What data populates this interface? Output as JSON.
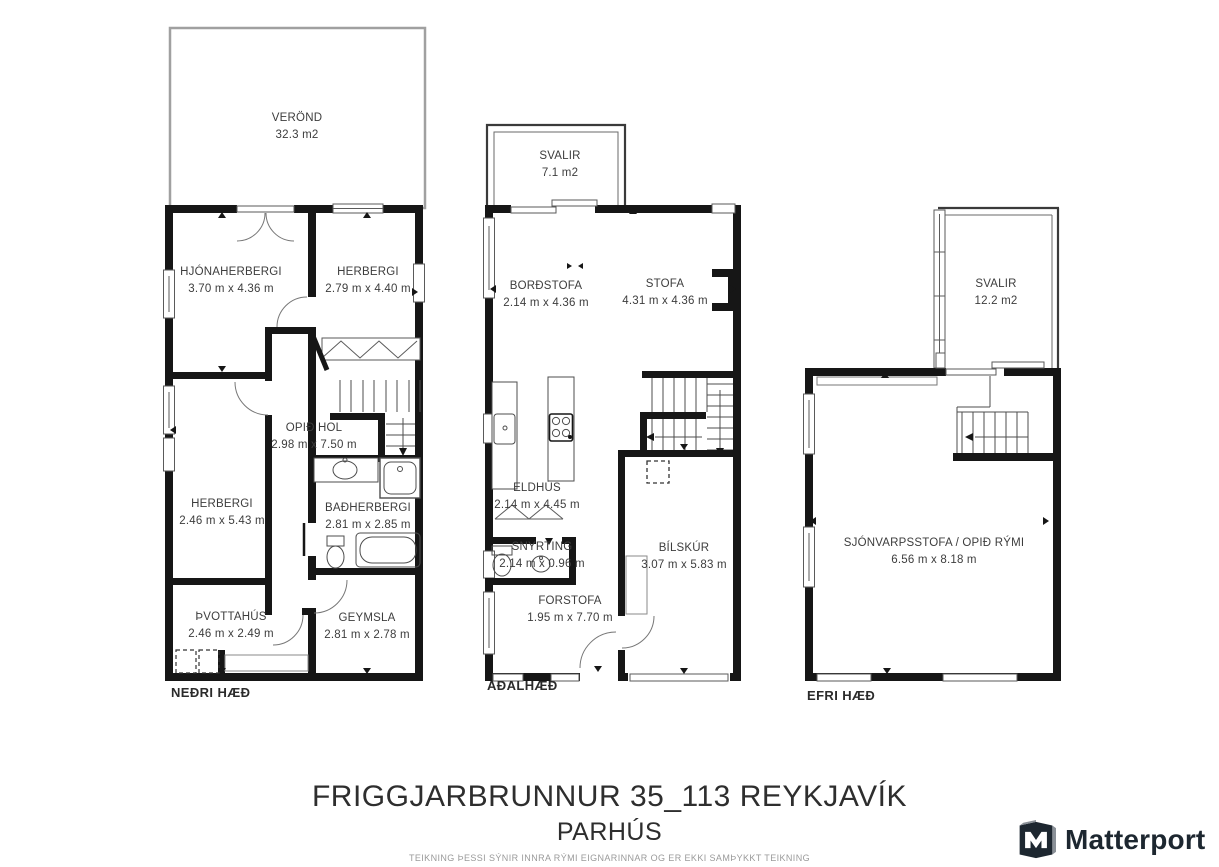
{
  "floors": [
    {
      "label": "NEÐRI HÆÐ",
      "rooms": [
        {
          "name": "VERÖND",
          "dims": "32.3 m2"
        },
        {
          "name": "HJÓNAHERBERGI",
          "dims": "3.70 m x 4.36 m"
        },
        {
          "name": "HERBERGI",
          "dims": "2.79 m x 4.40 m"
        },
        {
          "name": "OPIÐ HOL",
          "dims": "2.98 m x 7.50 m"
        },
        {
          "name": "HERBERGI",
          "dims": "2.46 m x 5.43 m"
        },
        {
          "name": "BAÐHERBERGI",
          "dims": "2.81 m x 2.85 m"
        },
        {
          "name": "ÞVOTTAHÚS",
          "dims": "2.46 m x 2.49 m"
        },
        {
          "name": "GEYMSLA",
          "dims": "2.81 m x 2.78 m"
        }
      ]
    },
    {
      "label": "AÐALHÆÐ",
      "rooms": [
        {
          "name": "SVALIR",
          "dims": "7.1 m2"
        },
        {
          "name": "BORÐSTOFA",
          "dims": "2.14 m x 4.36 m"
        },
        {
          "name": "STOFA",
          "dims": "4.31 m x 4.36 m"
        },
        {
          "name": "ELDHÚS",
          "dims": "2.14 m x 4.45 m"
        },
        {
          "name": "SNYRTING",
          "dims": "2.14 m x 0.96 m"
        },
        {
          "name": "BÍLSKÚR",
          "dims": "3.07 m x 5.83 m"
        },
        {
          "name": "FORSTOFA",
          "dims": "1.95 m x 7.70 m"
        }
      ]
    },
    {
      "label": "EFRI HÆÐ",
      "rooms": [
        {
          "name": "SVALIR",
          "dims": "12.2 m2"
        },
        {
          "name": "SJÓNVARPSSTOFA / OPIÐ RÝMI",
          "dims": "6.56 m x 8.18 m"
        }
      ]
    }
  ],
  "footer": {
    "address": "FRIGGJARBRUNNUR 35_113 REYKJAVÍK",
    "building_type": "PARHÚS",
    "disclaimer": "TEIKNING ÞESSI SÝNIR INNRA RÝMI EIGNARINNAR OG ER EKKI SAMÞYKKT TEIKNING"
  },
  "brand": {
    "name": "Matterport"
  },
  "colors": {
    "wall": "#161616",
    "thin_line": "#4d4d4d",
    "veranda_outline": "#a0a0a0",
    "label_text": "#3d3d3d",
    "disclaimer_text": "#9a9a9a",
    "brand_dark": "#1d2730"
  }
}
